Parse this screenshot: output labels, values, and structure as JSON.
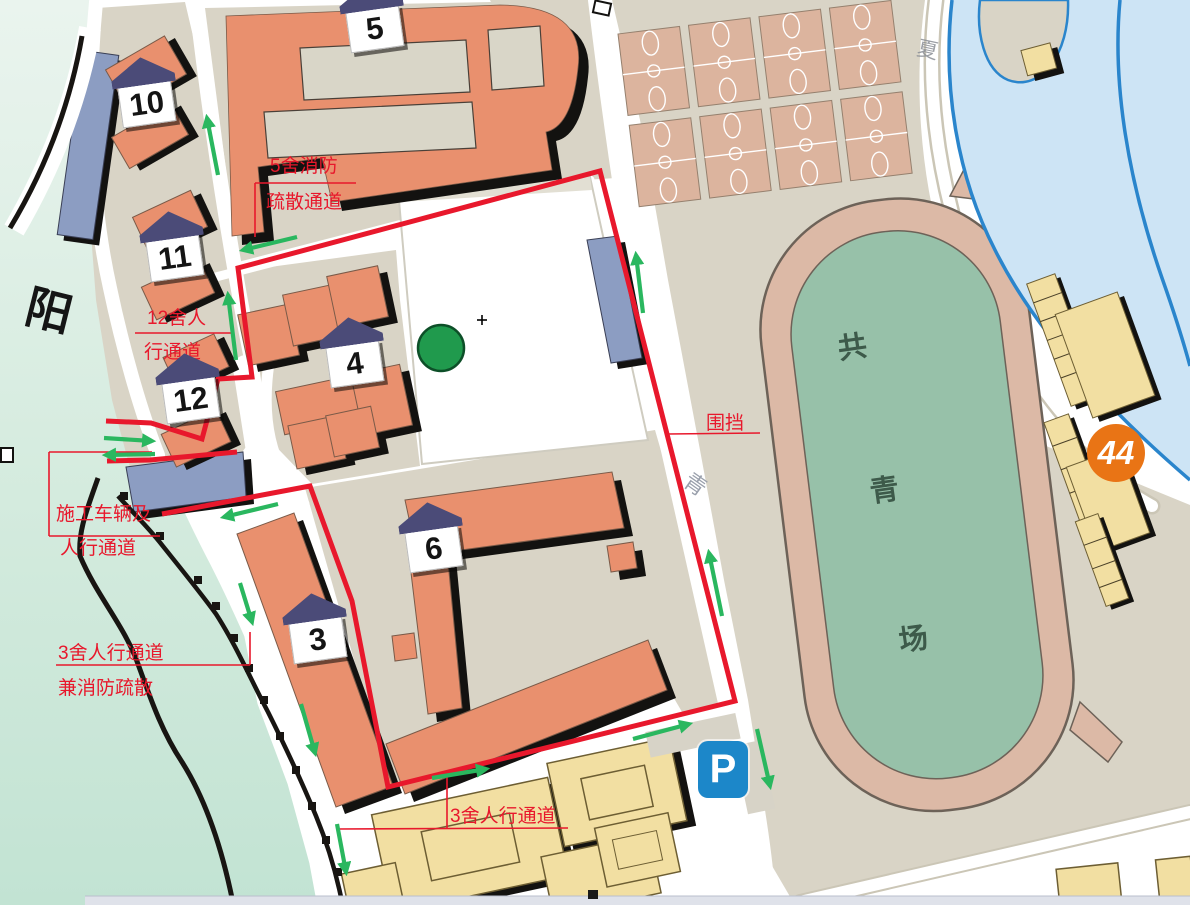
{
  "palette": {
    "ground": "#d9d4c6",
    "building_orange": "#e9906e",
    "building_blue": "#8c9dc2",
    "building_yellow": "#f2dfa2",
    "river_left_top": "#eaf4ee",
    "river_left_bottom": "#c2e3d3",
    "river_right": "#cde4f5",
    "river_stroke": "#2a85cc",
    "track": "#dcb9a6",
    "track_outline": "#6d6258",
    "field": "#97c1a9",
    "court": "#dcb49e",
    "fence_red": "#e8182c",
    "arrow_green": "#2ab75f",
    "badge_roof": "#4b4b78",
    "parking_blue": "#1c87c9",
    "badge44_orange": "#e97415",
    "tree": "#209a4d",
    "field_text": "#3d5a4a",
    "road_text": "#9aa0ac"
  },
  "map": {
    "river_name": "阳",
    "road_char_mid": "青",
    "road_char_top": "夏",
    "field_chars": [
      "共",
      "青",
      "场"
    ],
    "buildings": {
      "b3": "3",
      "b4": "4",
      "b5": "5",
      "b6": "6",
      "b10": "10",
      "b11": "11",
      "b12": "12"
    },
    "stop_badge": "44",
    "parking": "P"
  },
  "annotations": {
    "fence_label": "围挡",
    "route5_l1": "5舍消防",
    "route5_l2": "疏散通道",
    "route12_l1": "12舍人",
    "route12_l2": "行通道",
    "construction_l1": "施工车辆及",
    "construction_l2": "人行通道",
    "route3_l1": "3舍人行通道",
    "route3_l2": "兼消防疏散",
    "route3b": "3舍人行通道"
  }
}
